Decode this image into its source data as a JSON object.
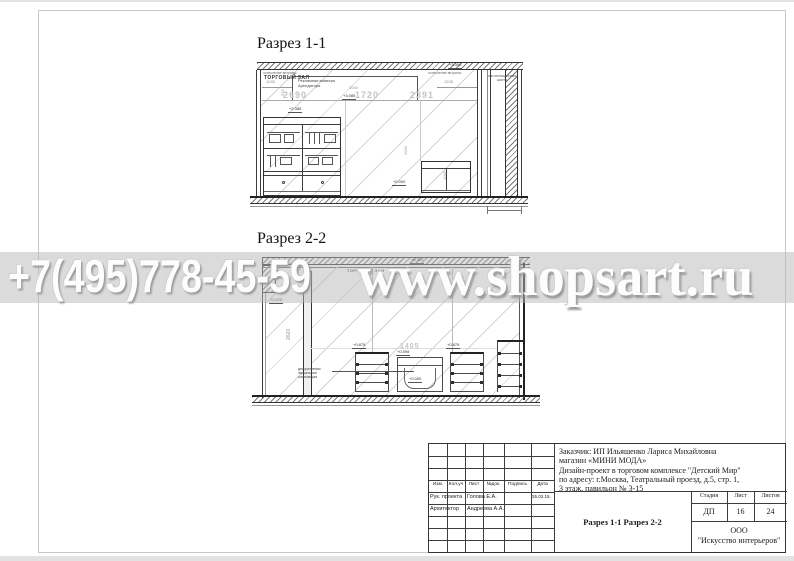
{
  "watermark": {
    "phone": "+7(495)778-45-59",
    "url": "www.shopsart.ru"
  },
  "section1": {
    "title": "Разрез 1-1",
    "labels": {
      "glazing_left": "остекление витрины",
      "glazing_right": "остекление витрины",
      "hall": "ТОРГОВЫЙ ЗАЛ",
      "sign1": "Рекламная вывеска",
      "sign2": "Арендатора",
      "shaft1": "инсталляционная",
      "shaft2": "шахта"
    },
    "dims": {
      "left_small": "1245",
      "right_small": "1245",
      "big1": "2690",
      "big2": "1720",
      "big3": "2391",
      "sign_width": "4000",
      "v1": "515",
      "v2": "2000",
      "v3": "1005"
    },
    "elev": {
      "top": "+3.300",
      "sign": "+3.085",
      "left": "+2.385",
      "floor": "+0.000"
    }
  },
  "section2": {
    "title": "Разрез 2-2",
    "labels": {
      "hall": "ТОРГОВЫЙ ЗАЛ",
      "note1": "декоративная",
      "note2": "зеркальная",
      "note3": "композиция"
    },
    "dims": {
      "span": "1405",
      "v1": "2620"
    },
    "elev": {
      "ceiling": "+3.300",
      "wall": "+2.070",
      "table_a": "+0.875",
      "table_b": "+0.875",
      "bench": "+0.595",
      "floor": "+0.000"
    }
  },
  "titleblock": {
    "header_cols": [
      "Изм.",
      "Кол.уч",
      "Лист",
      "№док.",
      "Подпись",
      "Дата"
    ],
    "row1_role": "Рук. проекта",
    "row1_name": "Голова Е.А.",
    "row1_date": "25.02.15.",
    "row2_role": "Архитектор",
    "row2_name": "Андреева А.А.",
    "client_lines": [
      "Заказчик:  ИП Ильяшенко Лариса Михайловна",
      "магазин «МИНИ МОДА»",
      "Дизайн-проект в  торговом  комплексе \"Детский Мир\"",
      "по адресу: г.Москва, Театральный проезд, д.5, стр. 1,",
      "3 этаж, павильон № 3-15"
    ],
    "stage_label": "Стадия",
    "sheet_label": "Лист",
    "sheets_label": "Листов",
    "stage": "ДП",
    "sheet": "16",
    "sheets": "24",
    "doc_title": "Разрез 1-1 Разрез 2-2",
    "company1": "ООО",
    "company2": "\"Искусство интерьеров\""
  }
}
